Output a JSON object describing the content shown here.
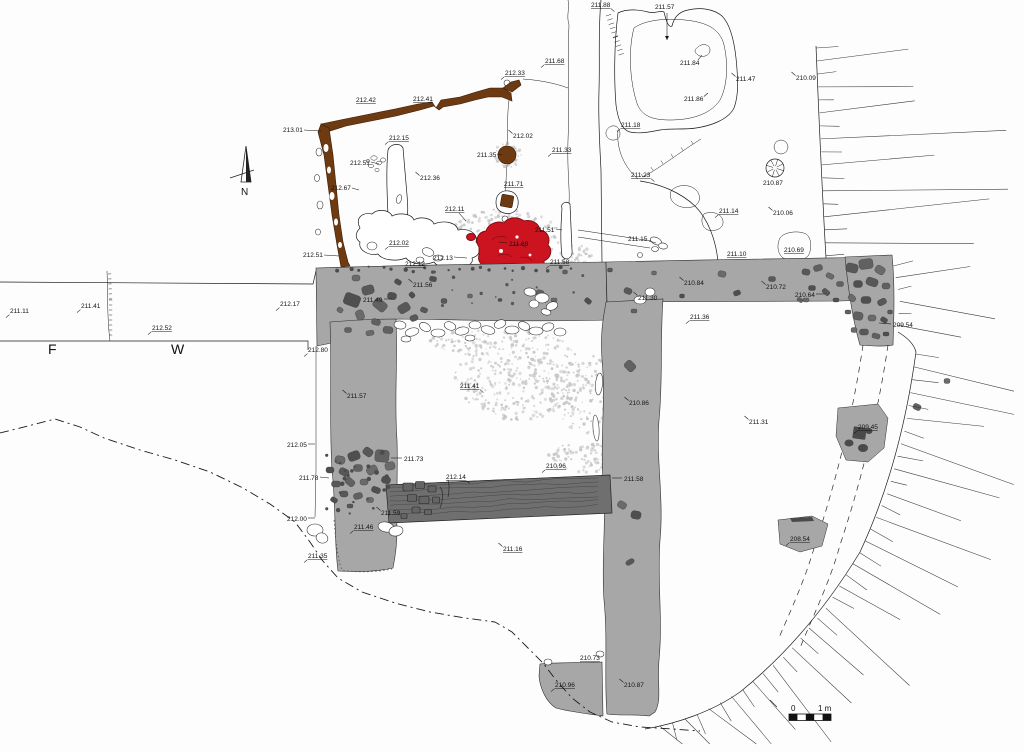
{
  "plan": {
    "north_label": "N",
    "scale_bar": {
      "start": "0",
      "end": "1 m"
    },
    "area_letters": [
      {
        "t": "F",
        "x": 48,
        "y": 354
      },
      {
        "t": "W",
        "x": 171,
        "y": 354
      }
    ],
    "labels": [
      {
        "t": "213.01",
        "x": 283,
        "y": 132,
        "ldr": [
          304,
          130,
          321,
          131
        ]
      },
      {
        "t": "212.42",
        "x": 356,
        "y": 102,
        "u": 1
      },
      {
        "t": "212.41",
        "x": 413,
        "y": 101,
        "u": 1
      },
      {
        "t": "212.33",
        "x": 505,
        "y": 75,
        "u": 1,
        "tick": "dl"
      },
      {
        "t": "211.68",
        "x": 545,
        "y": 63,
        "u": 1,
        "tick": "dl"
      },
      {
        "t": "212.02",
        "x": 513,
        "y": 138,
        "tick": "ul"
      },
      {
        "t": "211.33",
        "x": 552,
        "y": 152,
        "u": 1,
        "tick": "dl"
      },
      {
        "t": "212.15",
        "x": 389,
        "y": 140,
        "u": 1,
        "tick": "dl"
      },
      {
        "t": "212.51",
        "x": 350,
        "y": 165,
        "ldr": [
          371,
          162,
          379,
          164
        ]
      },
      {
        "t": "212.36",
        "x": 420,
        "y": 180,
        "tick": "ul"
      },
      {
        "t": "212.67",
        "x": 331,
        "y": 190,
        "ldr": [
          352,
          188,
          359,
          190
        ]
      },
      {
        "t": "211.35",
        "x": 477,
        "y": 157,
        "ldr": [
          497,
          154,
          502,
          155
        ]
      },
      {
        "t": "211.71",
        "x": 504,
        "y": 186,
        "u": 1
      },
      {
        "t": "212.11",
        "x": 445,
        "y": 211,
        "u": 1,
        "ldr": [
          459,
          213,
          466,
          221
        ]
      },
      {
        "t": "211.51",
        "x": 535,
        "y": 232,
        "ldr": [
          556,
          229,
          562,
          230
        ]
      },
      {
        "t": "212.02",
        "x": 389,
        "y": 245,
        "u": 1,
        "tick": "dl"
      },
      {
        "t": "212.51",
        "x": 303,
        "y": 257,
        "ldr": [
          324,
          255,
          339,
          256
        ]
      },
      {
        "t": "212.13",
        "x": 433,
        "y": 260,
        "ldr": [
          454,
          257,
          467,
          258
        ]
      },
      {
        "t": "211.69",
        "x": 509,
        "y": 246,
        "ldr": [
          507,
          243,
          499,
          242
        ]
      },
      {
        "t": "212.12",
        "x": 405,
        "y": 266,
        "u": 1
      },
      {
        "t": "211.58",
        "x": 550,
        "y": 264,
        "u": 1,
        "tick": "dl"
      },
      {
        "t": "211.88",
        "x": 591,
        "y": 7,
        "u": 1,
        "tick": "dr"
      },
      {
        "t": "211.57",
        "x": 655,
        "y": 9,
        "ldr": [
          667,
          13,
          667,
          40
        ],
        "arrow": 1
      },
      {
        "t": "211.84",
        "x": 680,
        "y": 65,
        "ldr": [
          698,
          60,
          702,
          55
        ]
      },
      {
        "t": "211.47",
        "x": 736,
        "y": 81,
        "tick": "ul"
      },
      {
        "t": "210.09",
        "x": 796,
        "y": 80,
        "tick": "ul"
      },
      {
        "t": "211.86",
        "x": 684,
        "y": 101,
        "tick": "ur"
      },
      {
        "t": "211.18",
        "x": 621,
        "y": 127,
        "u": 1,
        "tick": "dl"
      },
      {
        "t": "211.23",
        "x": 631,
        "y": 177,
        "u": 1,
        "tick": "dr"
      },
      {
        "t": "211.15",
        "x": 628,
        "y": 241,
        "ldr": [
          649,
          241,
          656,
          243
        ]
      },
      {
        "t": "211.14",
        "x": 719,
        "y": 213,
        "u": 1,
        "tick": "dl"
      },
      {
        "t": "210.06",
        "x": 773,
        "y": 215,
        "tick": "ul"
      },
      {
        "t": "210.87",
        "x": 763,
        "y": 185
      },
      {
        "t": "210.69",
        "x": 784,
        "y": 252,
        "u": 1
      },
      {
        "t": "211.10",
        "x": 727,
        "y": 256,
        "u": 1
      },
      {
        "t": "211.56",
        "x": 413,
        "y": 287,
        "tick": "ul"
      },
      {
        "t": "211.49",
        "x": 363,
        "y": 302,
        "ldr": [
          384,
          299,
          392,
          299
        ]
      },
      {
        "t": "211.30",
        "x": 638,
        "y": 300,
        "tick": "ul"
      },
      {
        "t": "210.84",
        "x": 684,
        "y": 285,
        "tick": "ul"
      },
      {
        "t": "210.72",
        "x": 766,
        "y": 289,
        "tick": "ul"
      },
      {
        "t": "210.64",
        "x": 795,
        "y": 297,
        "ldr": [
          816,
          294,
          825,
          294
        ]
      },
      {
        "t": "209.54",
        "x": 893,
        "y": 327,
        "ldr": [
          891,
          324,
          879,
          323
        ]
      },
      {
        "t": "211.36",
        "x": 690,
        "y": 319,
        "u": 1,
        "tick": "dl"
      },
      {
        "t": "211.11",
        "x": 10,
        "y": 313,
        "tick": "dl"
      },
      {
        "t": "211.41",
        "x": 81,
        "y": 308,
        "tick": "dl"
      },
      {
        "t": "212.52",
        "x": 152,
        "y": 330,
        "u": 1,
        "tick": "dl"
      },
      {
        "t": "212.17",
        "x": 280,
        "y": 306,
        "tick": "dl"
      },
      {
        "t": "212.80",
        "x": 308,
        "y": 352,
        "tick": "dl"
      },
      {
        "t": "211.57",
        "x": 347,
        "y": 398,
        "tick": "ul"
      },
      {
        "t": "212.05",
        "x": 287,
        "y": 447,
        "ldr": [
          308,
          444,
          315,
          444
        ]
      },
      {
        "t": "211.73",
        "x": 404,
        "y": 461,
        "ldr": [
          402,
          458,
          391,
          458
        ]
      },
      {
        "t": "211.78",
        "x": 299,
        "y": 480,
        "ldr": [
          320,
          477,
          329,
          478
        ]
      },
      {
        "t": "212.00",
        "x": 287,
        "y": 521,
        "ldr": [
          308,
          518,
          315,
          518
        ]
      },
      {
        "t": "211.46",
        "x": 354,
        "y": 529,
        "u": 1,
        "tick": "dl"
      },
      {
        "t": "211.35",
        "x": 308,
        "y": 558,
        "u": 1,
        "tick": "dl"
      },
      {
        "t": "211.59",
        "x": 381,
        "y": 515,
        "tick": "ul"
      },
      {
        "t": "211.41",
        "x": 460,
        "y": 388,
        "u": 1,
        "tick": "dr"
      },
      {
        "t": "212.14",
        "x": 446,
        "y": 479,
        "u": 1,
        "tick": "dr"
      },
      {
        "t": "210.96",
        "x": 546,
        "y": 468,
        "u": 1,
        "tick": "dl"
      },
      {
        "t": "211.58",
        "x": 624,
        "y": 481,
        "ldr": [
          622,
          478,
          612,
          478
        ]
      },
      {
        "t": "211.16",
        "x": 503,
        "y": 551,
        "u": 1,
        "tick": "ul"
      },
      {
        "t": "210.86",
        "x": 629,
        "y": 405,
        "tick": "ul"
      },
      {
        "t": "211.31",
        "x": 749,
        "y": 424,
        "tick": "ul"
      },
      {
        "t": "209.45",
        "x": 858,
        "y": 429,
        "u": 1,
        "tick": "dl"
      },
      {
        "t": "208.54",
        "x": 790,
        "y": 541,
        "u": 1,
        "tick": "dl"
      },
      {
        "t": "210.73",
        "x": 580,
        "y": 660,
        "u": 1
      },
      {
        "t": "210.96",
        "x": 555,
        "y": 687,
        "u": 1,
        "tick": "dl"
      },
      {
        "t": "210.87",
        "x": 624,
        "y": 687,
        "tick": "ul"
      }
    ]
  },
  "colors": {
    "wall": "#a7a7a7",
    "stone": "#565656",
    "cross_wall": "#6f6f6f",
    "beam": "#6d3a12",
    "burnt": "#cc1420",
    "burnt_dark": "#7c0a10",
    "stipple": "#c6c6c6",
    "line": "#1c1c1c"
  }
}
